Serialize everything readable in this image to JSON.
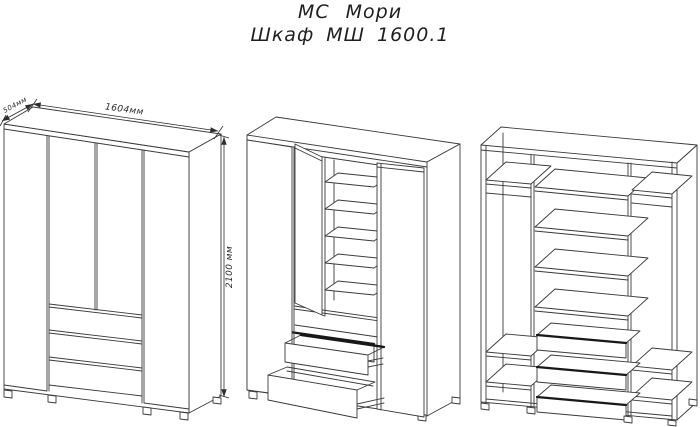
{
  "header": {
    "title": "МС Мори",
    "subtitle": "Шкаф МШ 1600.1"
  },
  "dimensions": {
    "width_label": "1604мм",
    "depth_label": "504мм",
    "height_label": "2100 мм"
  },
  "style": {
    "background": "#ffffff",
    "line_color": "#3a3a3a",
    "dark_line_color": "#181818",
    "text_color": "#1f1f1f"
  }
}
